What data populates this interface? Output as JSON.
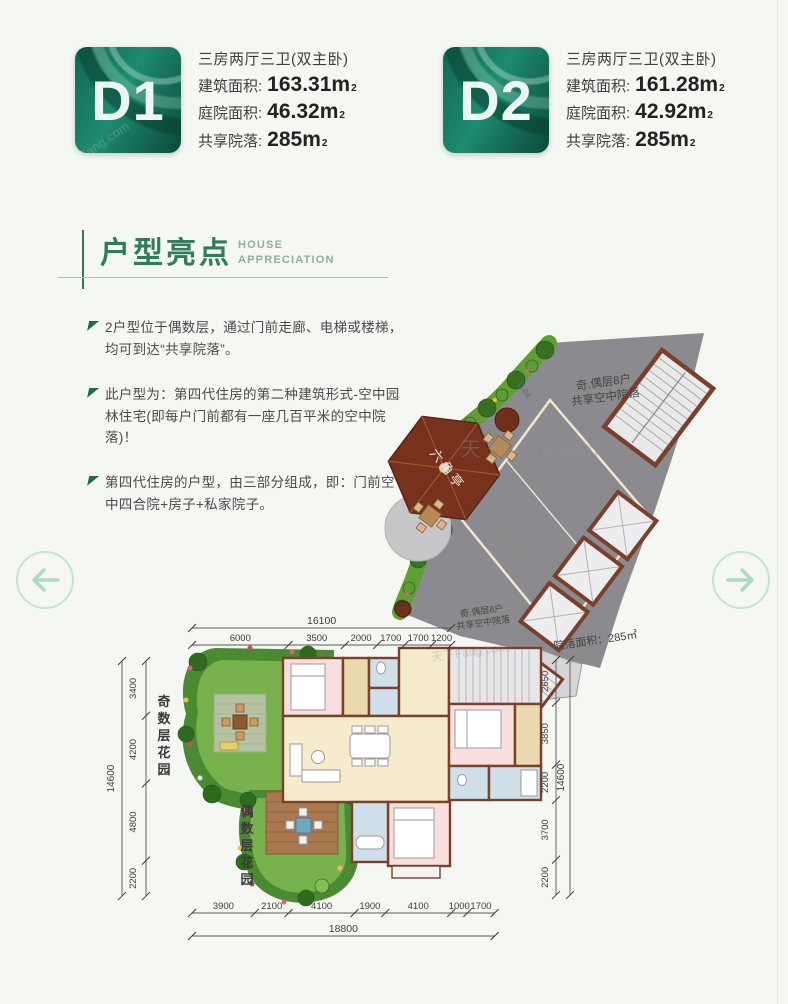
{
  "page": {
    "watermark": "天下Fang.com"
  },
  "units": [
    {
      "code": "D1",
      "layout": "三房两厅三卫(双主卧)",
      "fields": [
        {
          "label": "建筑面积:",
          "value": "163.31m",
          "sup": "2"
        },
        {
          "label": "庭院面积:",
          "value": "46.32m",
          "sup": "2"
        },
        {
          "label": "共享院落:",
          "value": "285m",
          "sup": "2"
        }
      ]
    },
    {
      "code": "D2",
      "layout": "三房两厅三卫(双主卧)",
      "fields": [
        {
          "label": "建筑面积:",
          "value": "161.28m",
          "sup": "2"
        },
        {
          "label": "庭院面积:",
          "value": "42.92m",
          "sup": "2"
        },
        {
          "label": "共享院落:",
          "value": "285m",
          "sup": "2"
        }
      ]
    }
  ],
  "section": {
    "title": "户型亮点",
    "subtitle": [
      "HOUSE",
      "APPRECIATION"
    ]
  },
  "highlights": [
    "2户型位于偶数层，通过门前走廊、电梯或楼梯，均可到达“共享院落”。",
    "此户型为：第四代住房的第二种建筑形式-空中园林住宅(即每户门前都有一座几百平米的空中院落)！",
    "第四代住房的户型，由三部分组成，即：门前空中四合院+房子+私家院子。"
  ],
  "floorplan": {
    "courtyard_note_line1": "奇.偶层8户",
    "courtyard_note_line2": "共享空中院落",
    "courtyard_area_label": "院落面积：285㎡",
    "pavilion_label": "六角亭",
    "court_label": "羽毛球场",
    "stair_code": "E-04",
    "garden_odd_label": "奇数层花园",
    "garden_even_label": "偶数层花园",
    "dimensions": {
      "top": {
        "total": "16100",
        "segments": [
          "6000",
          "3500",
          "2000",
          "1700",
          "1700",
          "1200"
        ]
      },
      "bottom": {
        "total": "18800",
        "segments": [
          "3900",
          "2100",
          "4100",
          "1900",
          "4100",
          "1000",
          "1700"
        ]
      },
      "left": {
        "total": "14600",
        "segments": [
          "3400",
          "4200",
          "4800",
          "2200"
        ]
      },
      "right": {
        "total": "14600",
        "segments": [
          "2650",
          "3850",
          "2200",
          "3700",
          "2200"
        ]
      }
    }
  },
  "icons": {
    "prev": "arrow-left-icon",
    "next": "arrow-right-icon"
  }
}
